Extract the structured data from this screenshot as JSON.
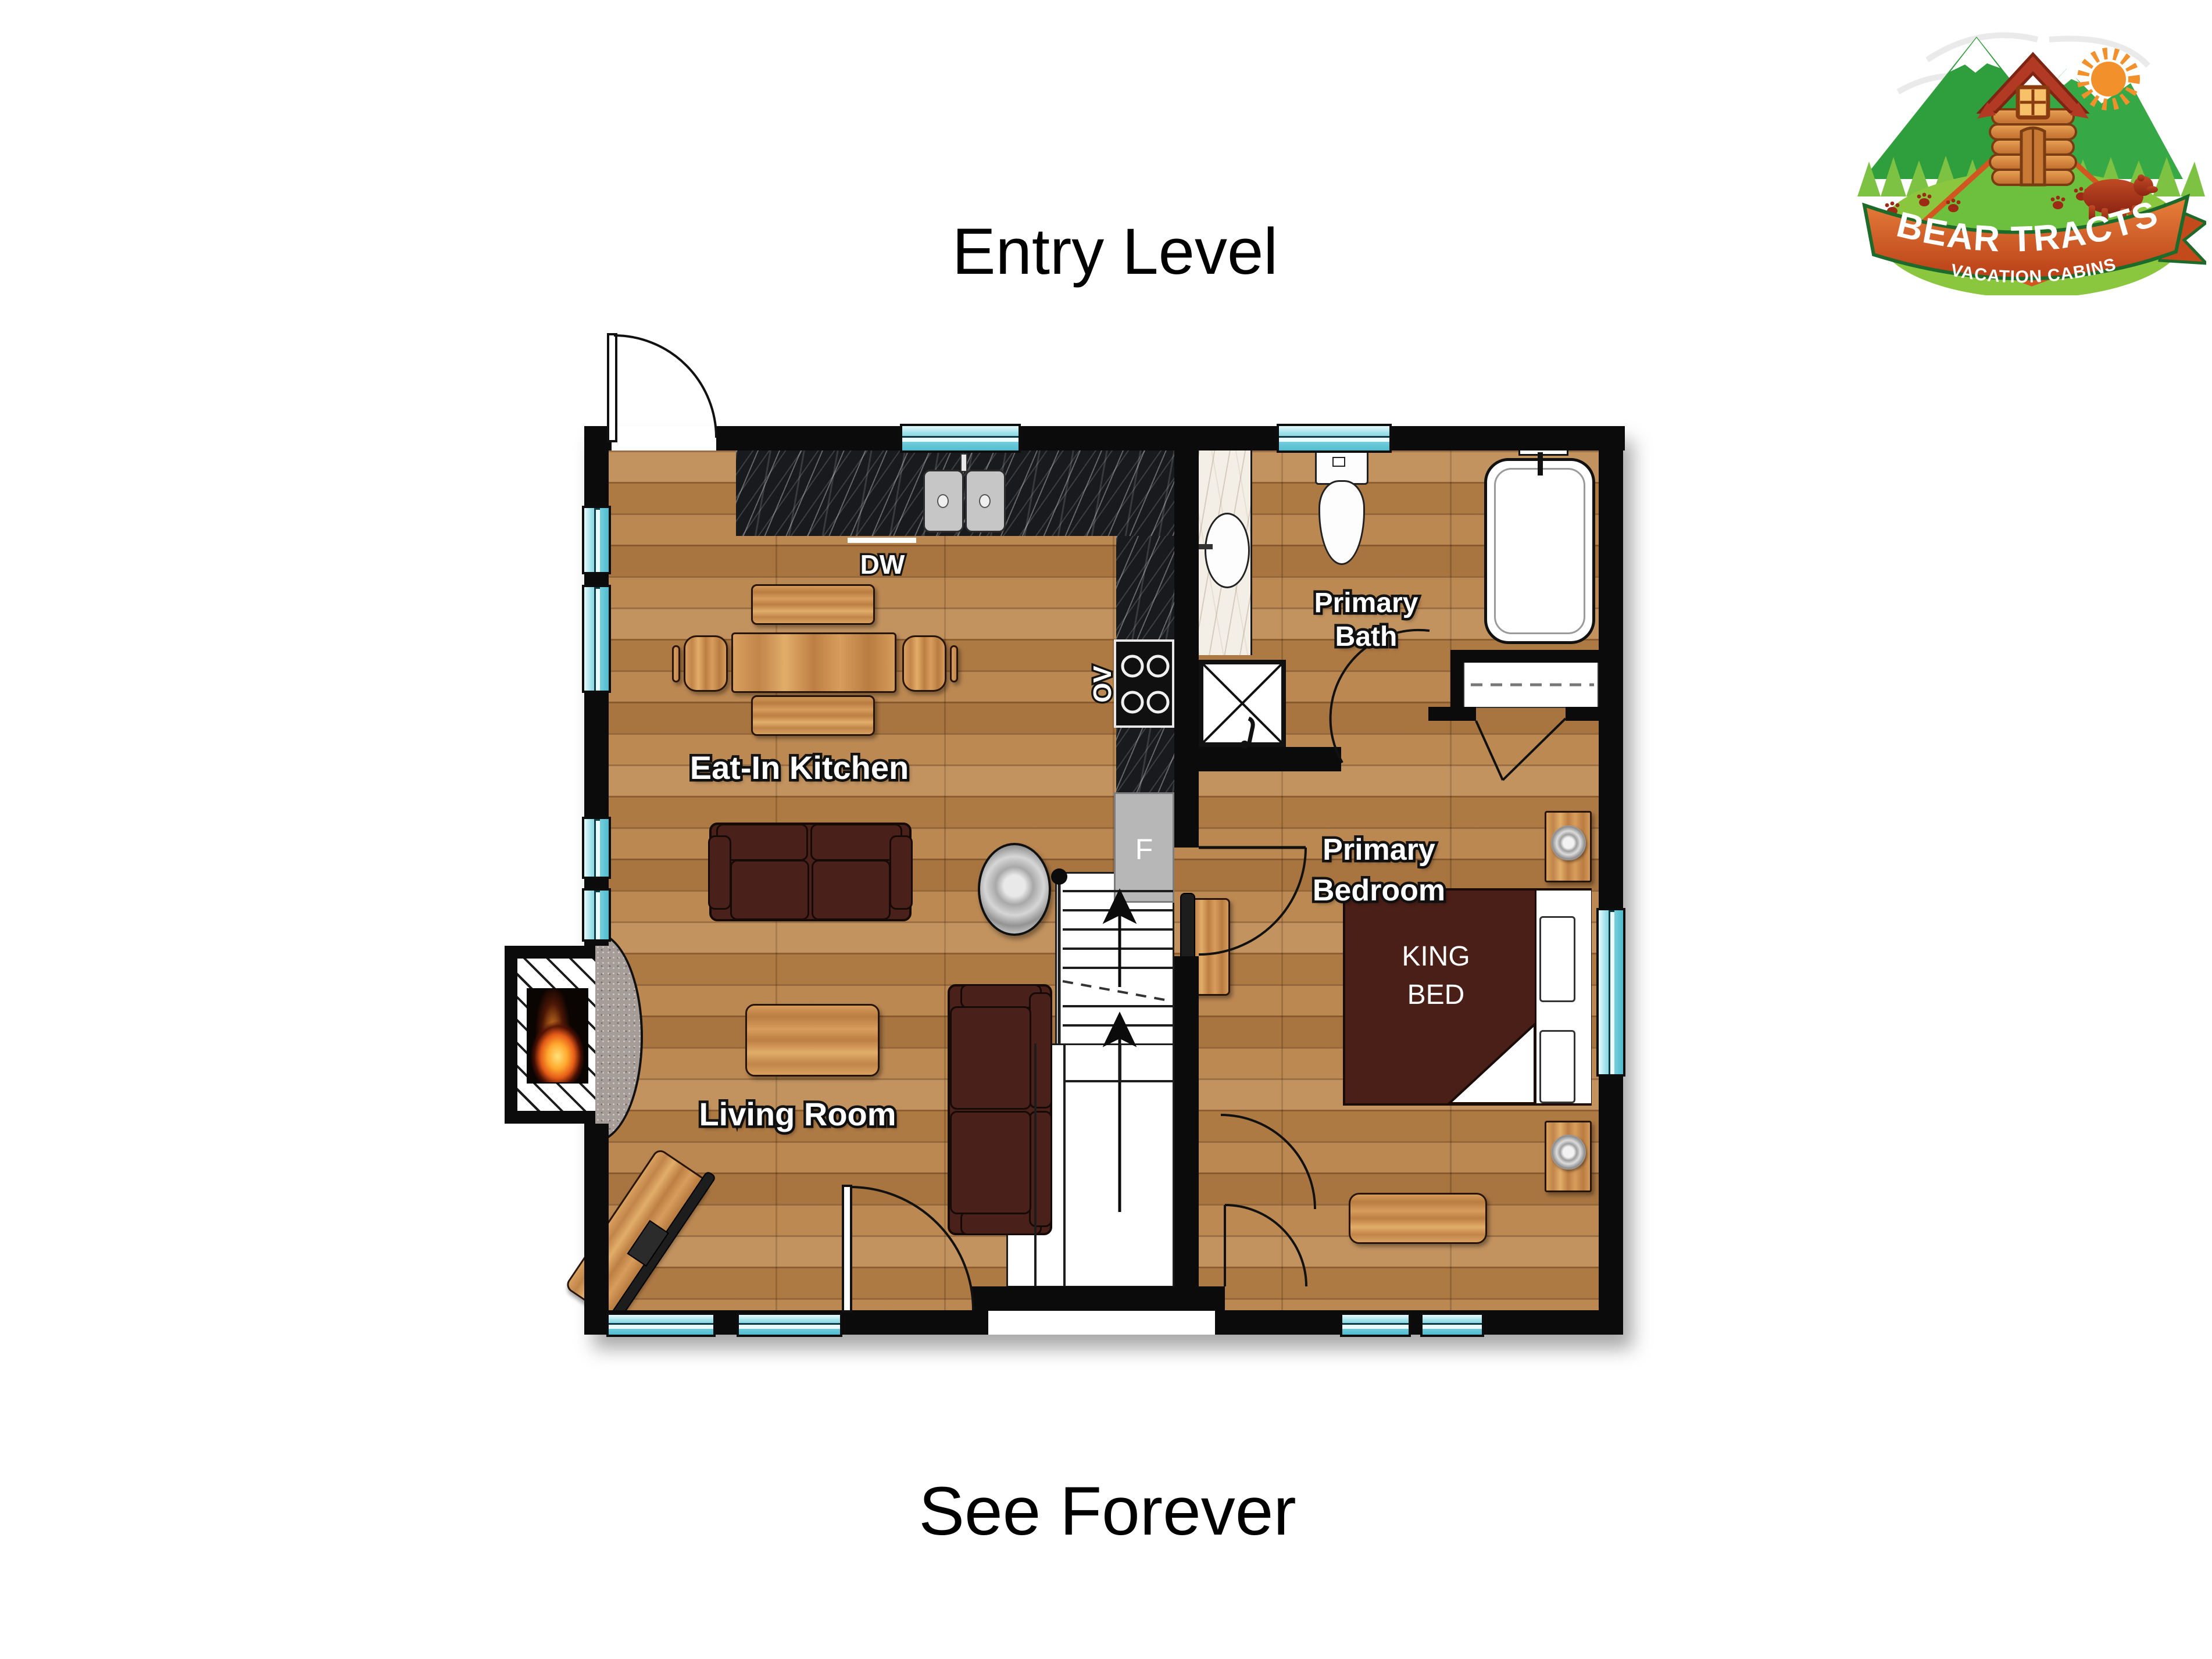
{
  "page": {
    "title_top": "Entry Level",
    "title_bottom": "See Forever",
    "background": "#ffffff"
  },
  "logo": {
    "name_line": "BEAR TRACTS",
    "tagline": "VACATION CABINS",
    "colors": {
      "mountain_green": "#2f9e3d",
      "tree_green": "#7dc242",
      "grass_green": "#8bc63f",
      "ribbon_orange": "#d2561f",
      "ribbon_light": "#e8813c",
      "bear_red": "#a23119",
      "sun_orange": "#f2902b",
      "cabin_log": "#d2803b",
      "roof_red": "#b23a24"
    }
  },
  "rooms": {
    "kitchen": {
      "label": "Eat-In Kitchen"
    },
    "living": {
      "label": "Living Room"
    },
    "bath": {
      "line1": "Primary",
      "line2": "Bath"
    },
    "bedroom": {
      "line1": "Primary",
      "line2": "Bedroom"
    }
  },
  "fixtures": {
    "dishwasher": "DW",
    "oven": "OV",
    "fridge": "F",
    "bed_line1": "KING",
    "bed_line2": "BED"
  },
  "colors": {
    "wall": "#0b0b0b",
    "window_teal": "#6fcbda",
    "wood_floor": "#b6814b",
    "sofa_brown": "#4a211a",
    "bed_brown": "#4a1f17",
    "counter_black_marble": "#191a1d",
    "vanity_white_marble": "#f3efe7",
    "appliance_gray": "#b7b7b7",
    "hearth_granite": "#a69d99"
  }
}
